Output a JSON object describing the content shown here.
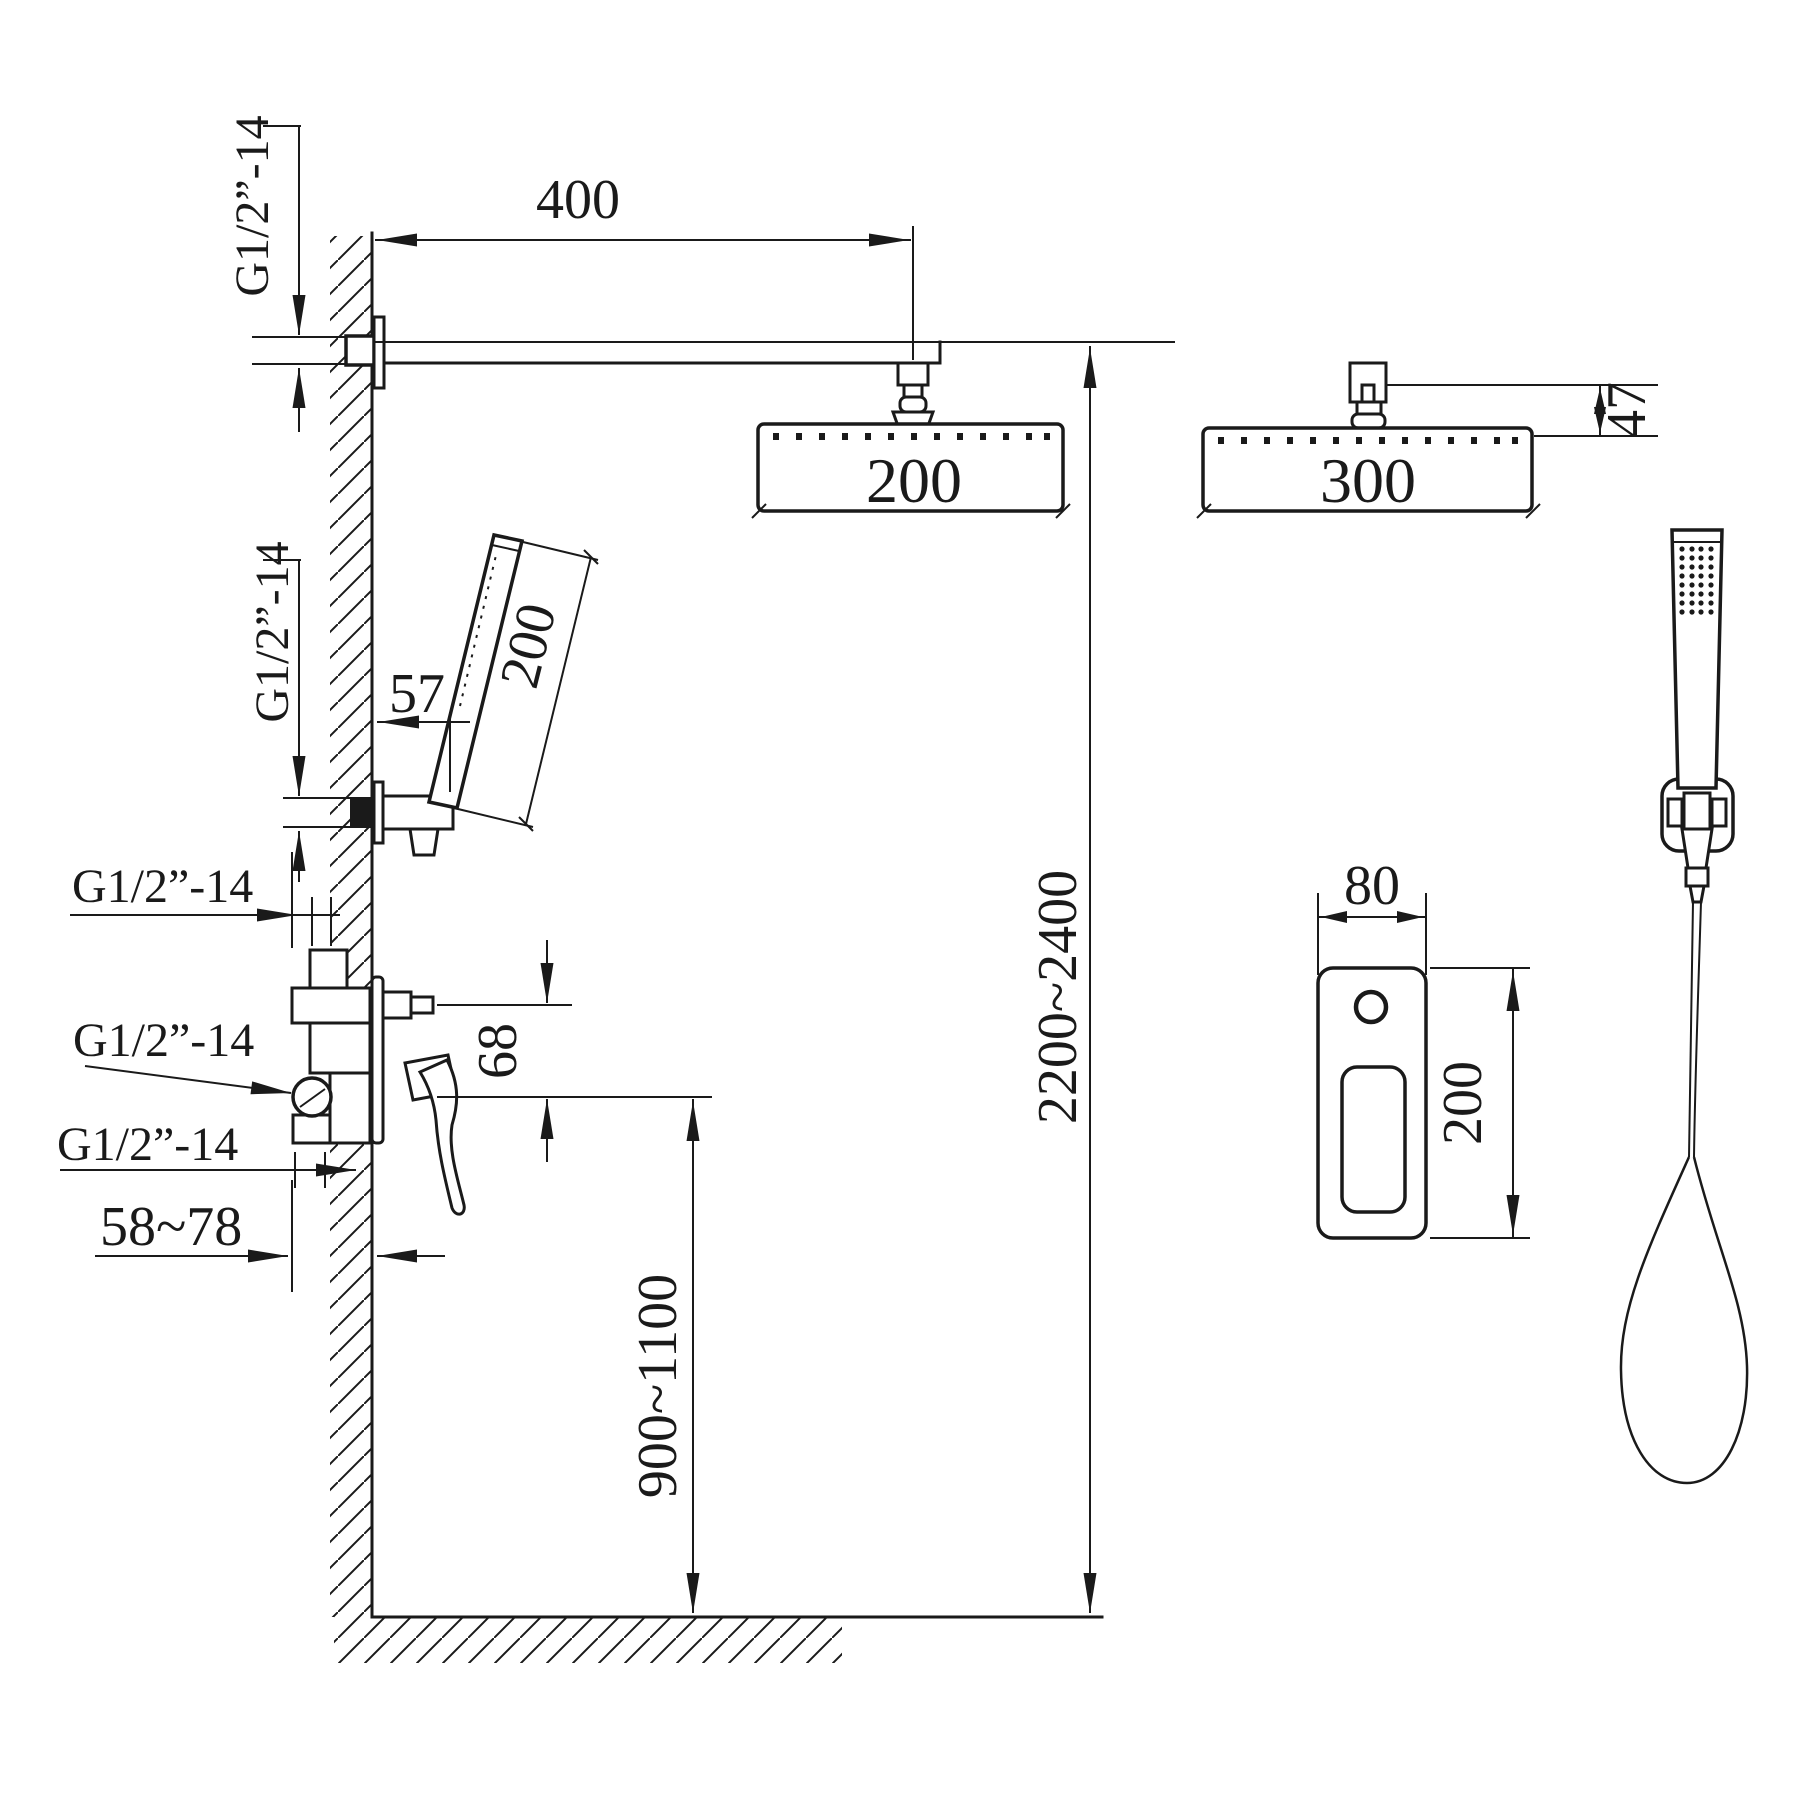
{
  "colors": {
    "line": "#1a1a1a",
    "background": "#ffffff"
  },
  "labels": {
    "thread_arm": "G1/2”-14",
    "thread_handshower": "G1/2”-14",
    "thread_inlet_top": "G1/2”-14",
    "thread_inlet_middle": "G1/2”-14",
    "thread_outlet_bottom": "G1/2”-14"
  },
  "dimensions": {
    "arm_length": "400",
    "overhead_width_side": "200",
    "overhead_width_front": "300",
    "overhead_height": "47",
    "handshower_length": "200",
    "handshower_offset": "57",
    "port_spacing": "68",
    "wall_depth_range": "58~78",
    "mixer_mount_height": "900~1100",
    "overall_height": "2200~2400",
    "trim_plate_width": "80",
    "trim_plate_height": "200"
  }
}
